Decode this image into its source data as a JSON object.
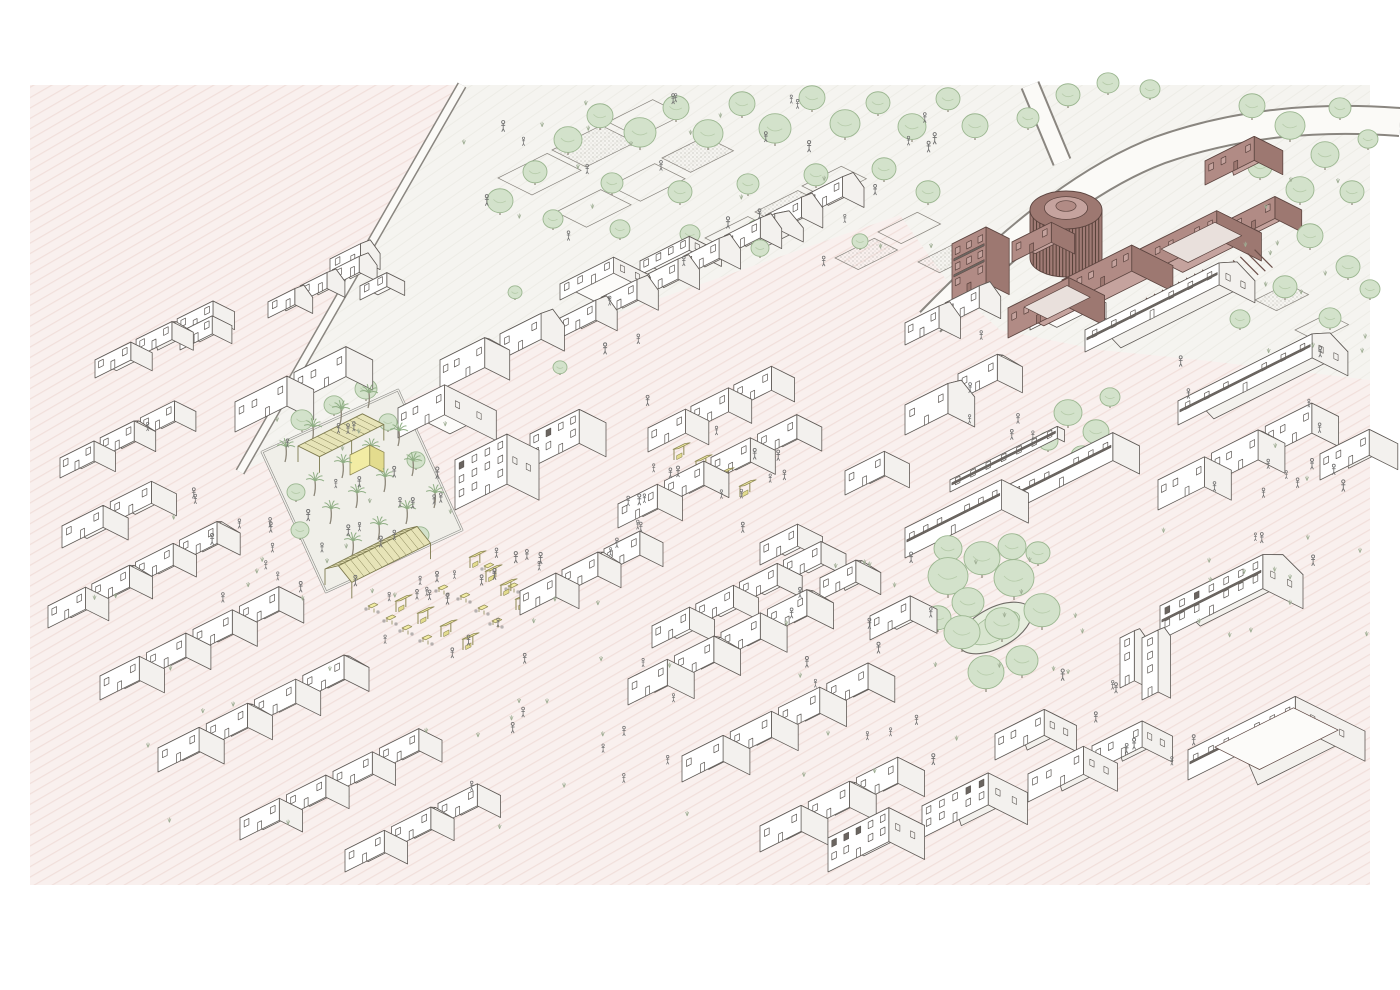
{
  "title": "Axonometric urban masterplan illustration",
  "palette": {
    "page": "#ffffff",
    "ground_pink": "#f9f0ee",
    "ground_hatch": "#f1dfdb",
    "park": "#f5f4f0",
    "park_hatch": "#edece6",
    "line": "#5f5a56",
    "house_front": "#ffffff",
    "house_side": "#f3f1ee",
    "house_top": "#fcfbf9",
    "roof_front": "#fdfcfa",
    "roof_back": "#f3f1ed",
    "mauve_front": "#b18b85",
    "mauve_side": "#9d7871",
    "mauve_top": "#c5a39e",
    "mauve_line": "#5d4540",
    "mauve_court": "#e9e0dc",
    "rotunda_body": "#a07b75",
    "rotunda_fin": "#564038",
    "yellow": "#f2eca4",
    "yellow_side": "#e3dc8e",
    "olive_line": "#8f8a55",
    "lattice": "#e7e4b8",
    "lattice_line": "#7d7a4e",
    "tree_fill": "#d3e2cb",
    "tree_line": "#9cb791",
    "trunk": "#8c8678",
    "people": "#6f6f6f",
    "shrub": "#9fae94",
    "road_edge": "#8a8680",
    "field_line": "#8a867f"
  },
  "scene": {
    "frame": {
      "x": 30,
      "y": 85,
      "w": 1340,
      "h": 800
    },
    "park": [
      [
        462,
        85
      ],
      [
        1370,
        85
      ],
      [
        1370,
        380
      ],
      [
        1200,
        360
      ],
      [
        1100,
        350
      ],
      [
        1000,
        330
      ],
      [
        950,
        285
      ],
      [
        900,
        215
      ],
      [
        560,
        333
      ],
      [
        240,
        472
      ]
    ],
    "roads": [
      {
        "d": "M 462 85 L 240 472",
        "w1": 10,
        "w2": 7
      },
      {
        "d": "M 930 322 C 1000 250 1080 180 1160 150 C 1240 122 1320 116 1400 122",
        "w1": 30,
        "w2": 26
      },
      {
        "d": "M 1030 85 L 1062 162",
        "w1": 20,
        "w2": 16
      }
    ],
    "fields": [
      [
        498,
        178,
        55,
        38,
        0
      ],
      [
        552,
        150,
        55,
        38,
        1
      ],
      [
        608,
        122,
        50,
        34,
        0
      ],
      [
        556,
        212,
        50,
        34,
        0
      ],
      [
        610,
        186,
        50,
        34,
        0
      ],
      [
        662,
        158,
        48,
        32,
        1
      ],
      [
        705,
        238,
        48,
        30,
        0
      ],
      [
        755,
        212,
        48,
        30,
        1
      ],
      [
        802,
        186,
        44,
        28,
        0
      ],
      [
        835,
        258,
        44,
        26,
        1
      ],
      [
        878,
        232,
        44,
        26,
        0
      ],
      [
        918,
        262,
        40,
        24,
        1
      ],
      [
        1255,
        300,
        36,
        24,
        1
      ],
      [
        1295,
        330,
        36,
        24,
        0
      ]
    ],
    "plaza": {
      "points": [
        [
          262,
          452
        ],
        [
          398,
          390
        ],
        [
          462,
          530
        ],
        [
          326,
          592
        ]
      ],
      "palms": [
        [
          285,
          462
        ],
        [
          312,
          442
        ],
        [
          340,
          424
        ],
        [
          368,
          408
        ],
        [
          398,
          446
        ],
        [
          370,
          462
        ],
        [
          342,
          478
        ],
        [
          314,
          496
        ],
        [
          330,
          524
        ],
        [
          356,
          508
        ],
        [
          384,
          492
        ],
        [
          412,
          476
        ],
        [
          352,
          556
        ],
        [
          378,
          540
        ],
        [
          406,
          524
        ],
        [
          434,
          508
        ]
      ],
      "pav_flat": {
        "x": 298,
        "y": 462,
        "w": 72,
        "d": 24,
        "z": 16
      },
      "pav_gable": {
        "x": 325,
        "y": 585,
        "w": 88,
        "d": 30,
        "h": 16,
        "rh": 10
      },
      "yellow_box": {
        "x": 350,
        "y": 475,
        "w": 22,
        "d": 16,
        "h": 20
      }
    },
    "house_rows": [
      [
        95,
        378,
        3,
        40,
        24,
        18,
        1,
        6
      ],
      [
        235,
        432,
        2,
        58,
        30,
        30,
        0,
        8
      ],
      [
        268,
        318,
        3,
        30,
        20,
        16,
        2,
        6
      ],
      [
        60,
        478,
        3,
        38,
        24,
        20,
        1,
        7
      ],
      [
        62,
        548,
        2,
        46,
        28,
        22,
        0,
        8
      ],
      [
        48,
        628,
        4,
        42,
        26,
        22,
        1,
        7
      ],
      [
        100,
        700,
        4,
        44,
        28,
        24,
        0,
        8
      ],
      [
        158,
        772,
        4,
        46,
        28,
        24,
        1,
        8
      ],
      [
        240,
        840,
        4,
        44,
        26,
        22,
        0,
        8
      ],
      [
        345,
        872,
        3,
        44,
        26,
        22,
        1,
        8
      ],
      [
        560,
        338,
        7,
        40,
        24,
        20,
        2,
        6
      ],
      [
        618,
        528,
        4,
        44,
        28,
        24,
        0,
        8
      ],
      [
        628,
        705,
        4,
        44,
        30,
        26,
        1,
        8
      ],
      [
        682,
        782,
        4,
        46,
        30,
        26,
        0,
        8
      ],
      [
        760,
        852,
        3,
        46,
        30,
        26,
        1,
        8
      ],
      [
        652,
        648,
        4,
        42,
        28,
        22,
        0,
        7
      ],
      [
        905,
        345,
        2,
        38,
        24,
        22,
        2,
        7
      ],
      [
        1158,
        510,
        3,
        52,
        30,
        30,
        1,
        8
      ],
      [
        520,
        615,
        3,
        40,
        26,
        24,
        1,
        7
      ],
      [
        648,
        452,
        3,
        42,
        26,
        24,
        0,
        6
      ]
    ],
    "house_singles": [
      [
        330,
        275,
        34,
        22,
        16,
        2,
        0
      ],
      [
        360,
        300,
        30,
        20,
        14,
        0,
        0
      ],
      [
        180,
        350,
        36,
        22,
        18,
        0,
        0
      ],
      [
        398,
        438,
        52,
        58,
        30,
        0,
        0
      ],
      [
        455,
        510,
        58,
        36,
        50,
        1,
        0
      ],
      [
        530,
        468,
        55,
        30,
        34,
        1,
        0
      ],
      [
        440,
        390,
        50,
        28,
        30,
        1,
        0
      ],
      [
        500,
        360,
        46,
        26,
        26,
        2,
        0
      ],
      [
        560,
        300,
        60,
        40,
        16,
        0,
        0
      ],
      [
        640,
        275,
        55,
        36,
        14,
        0,
        0
      ],
      [
        730,
        250,
        50,
        32,
        14,
        2,
        0
      ],
      [
        905,
        558,
        108,
        30,
        30,
        0,
        0
      ],
      [
        1010,
        512,
        115,
        30,
        28,
        0,
        0
      ],
      [
        905,
        435,
        48,
        30,
        30,
        2,
        0
      ],
      [
        958,
        400,
        44,
        28,
        26,
        1,
        0
      ],
      [
        950,
        492,
        120,
        8,
        12,
        0,
        0
      ],
      [
        1030,
        330,
        55,
        30,
        16,
        0,
        0
      ],
      [
        1085,
        352,
        150,
        40,
        22,
        2,
        0
      ],
      [
        1178,
        425,
        150,
        40,
        24,
        2,
        0
      ],
      [
        1320,
        480,
        55,
        32,
        26,
        1,
        0
      ],
      [
        828,
        872,
        68,
        40,
        34,
        0,
        0
      ],
      [
        922,
        838,
        74,
        44,
        32,
        1,
        0
      ],
      [
        1028,
        802,
        62,
        38,
        28,
        1,
        0
      ],
      [
        1092,
        772,
        56,
        34,
        26,
        1,
        0
      ],
      [
        1120,
        688,
        16,
        12,
        50,
        2,
        0
      ],
      [
        1142,
        700,
        18,
        14,
        62,
        2,
        0
      ],
      [
        1160,
        640,
        115,
        45,
        34,
        2,
        0
      ],
      [
        1188,
        780,
        120,
        78,
        30,
        1,
        0
      ],
      [
        995,
        760,
        55,
        36,
        26,
        1,
        0
      ],
      [
        870,
        640,
        45,
        30,
        24,
        0,
        0
      ],
      [
        820,
        600,
        40,
        28,
        22,
        1,
        0
      ],
      [
        760,
        565,
        42,
        28,
        22,
        0,
        0
      ],
      [
        845,
        495,
        44,
        28,
        24,
        0,
        0
      ],
      [
        952,
        300,
        38,
        26,
        56,
        0,
        1
      ],
      [
        1008,
        338,
        68,
        40,
        30,
        0,
        1
      ],
      [
        1012,
        262,
        44,
        26,
        20,
        0,
        1
      ],
      [
        1062,
        306,
        78,
        46,
        26,
        0,
        1
      ],
      [
        1138,
        278,
        88,
        50,
        28,
        0,
        1
      ],
      [
        1232,
        240,
        48,
        30,
        22,
        0,
        1
      ],
      [
        1205,
        185,
        55,
        32,
        24,
        1,
        1
      ]
    ],
    "rotunda": {
      "cx": 1066,
      "cy": 258,
      "rx": 36,
      "ry": 19,
      "h": 48
    },
    "pergolas": [
      [
        1146,
        322,
        8,
        9,
        26,
        24,
        14
      ],
      [
        1226,
        286,
        5,
        8,
        20,
        22,
        13
      ]
    ],
    "insets": [
      [
        1008,
        338,
        10,
        58,
        8,
        34,
        30,
        "mauve_court"
      ],
      [
        1138,
        278,
        14,
        74,
        12,
        42,
        28,
        "mauve_court"
      ],
      [
        1188,
        780,
        16,
        104,
        14,
        64,
        32,
        "house_top"
      ]
    ],
    "garden_oval": {
      "cx": 995,
      "cy": 628,
      "rx": 40,
      "ry": 20,
      "rot": -28
    },
    "trees": [
      [
        500,
        215,
        13
      ],
      [
        535,
        185,
        12
      ],
      [
        568,
        155,
        14
      ],
      [
        600,
        130,
        13
      ],
      [
        640,
        150,
        16
      ],
      [
        676,
        122,
        13
      ],
      [
        708,
        150,
        15
      ],
      [
        742,
        118,
        13
      ],
      [
        775,
        146,
        16
      ],
      [
        812,
        112,
        13
      ],
      [
        845,
        140,
        15
      ],
      [
        878,
        116,
        12
      ],
      [
        912,
        142,
        14
      ],
      [
        948,
        112,
        12
      ],
      [
        975,
        140,
        13
      ],
      [
        612,
        195,
        11
      ],
      [
        680,
        205,
        12
      ],
      [
        748,
        196,
        11
      ],
      [
        816,
        188,
        12
      ],
      [
        884,
        182,
        12
      ],
      [
        928,
        205,
        12
      ],
      [
        553,
        230,
        10
      ],
      [
        620,
        240,
        10
      ],
      [
        690,
        245,
        10
      ],
      [
        757,
        240,
        10
      ],
      [
        1252,
        120,
        13
      ],
      [
        1290,
        142,
        15
      ],
      [
        1325,
        170,
        14
      ],
      [
        1352,
        205,
        12
      ],
      [
        1300,
        205,
        14
      ],
      [
        1260,
        180,
        12
      ],
      [
        1340,
        120,
        11
      ],
      [
        1368,
        150,
        10
      ],
      [
        1310,
        250,
        13
      ],
      [
        1348,
        280,
        12
      ],
      [
        1285,
        300,
        12
      ],
      [
        1330,
        330,
        11
      ],
      [
        1370,
        300,
        10
      ],
      [
        1240,
        330,
        10
      ],
      [
        1068,
        108,
        12
      ],
      [
        1108,
        95,
        11
      ],
      [
        1150,
        100,
        10
      ],
      [
        1028,
        130,
        11
      ],
      [
        1068,
        428,
        14
      ],
      [
        1096,
        446,
        13
      ],
      [
        1082,
        468,
        11
      ],
      [
        1110,
        408,
        10
      ],
      [
        1048,
        452,
        10
      ],
      [
        948,
        598,
        20
      ],
      [
        982,
        578,
        18
      ],
      [
        1014,
        600,
        20
      ],
      [
        1042,
        630,
        18
      ],
      [
        1002,
        642,
        17
      ],
      [
        962,
        652,
        18
      ],
      [
        986,
        692,
        18
      ],
      [
        1022,
        678,
        16
      ],
      [
        948,
        564,
        14
      ],
      [
        1012,
        562,
        14
      ],
      [
        938,
        632,
        13
      ],
      [
        1038,
        566,
        12
      ],
      [
        968,
        620,
        16
      ],
      [
        302,
        432,
        11
      ],
      [
        334,
        416,
        10
      ],
      [
        366,
        401,
        11
      ],
      [
        296,
        502,
        9
      ],
      [
        388,
        432,
        9
      ],
      [
        416,
        470,
        9
      ],
      [
        300,
        540,
        9
      ],
      [
        420,
        545,
        9
      ],
      [
        760,
        258,
        9
      ],
      [
        700,
        262,
        8
      ],
      [
        860,
        250,
        8
      ],
      [
        560,
        375,
        7
      ],
      [
        515,
        300,
        7
      ]
    ],
    "stalls": [
      [
        396,
        612,
        1
      ],
      [
        418,
        624,
        1
      ],
      [
        441,
        637,
        1
      ],
      [
        463,
        650,
        1
      ],
      [
        470,
        568,
        2
      ],
      [
        486,
        582,
        2
      ],
      [
        501,
        596,
        2
      ],
      [
        516,
        610,
        2
      ],
      [
        652,
        448,
        1
      ],
      [
        674,
        460,
        1
      ],
      [
        696,
        472,
        1
      ],
      [
        718,
        485,
        1
      ],
      [
        740,
        497,
        1
      ]
    ],
    "tables": [
      [
        402,
        632
      ],
      [
        422,
        642
      ],
      [
        478,
        612
      ],
      [
        492,
        625
      ],
      [
        460,
        600
      ],
      [
        438,
        592
      ],
      [
        508,
        590
      ],
      [
        484,
        570
      ],
      [
        368,
        610
      ],
      [
        386,
        622
      ]
    ],
    "people_zones": [
      [
        265,
        420,
        200,
        190,
        26
      ],
      [
        375,
        555,
        170,
        110,
        16
      ],
      [
        635,
        430,
        150,
        105,
        12
      ],
      [
        460,
        95,
        480,
        170,
        22
      ],
      [
        1150,
        350,
        210,
        150,
        10
      ],
      [
        545,
        300,
        110,
        260,
        10
      ],
      [
        770,
        555,
        170,
        210,
        12
      ],
      [
        70,
        400,
        230,
        210,
        8
      ],
      [
        450,
        650,
        240,
        160,
        10
      ],
      [
        1060,
        620,
        150,
        150,
        8
      ],
      [
        960,
        330,
        80,
        120,
        6
      ],
      [
        1240,
        430,
        120,
        180,
        6
      ]
    ],
    "shrub_zones": [
      [
        60,
        500,
        300,
        330,
        14
      ],
      [
        420,
        600,
        300,
        230,
        14
      ],
      [
        1150,
        340,
        220,
        300,
        16
      ],
      [
        460,
        95,
        480,
        170,
        14
      ],
      [
        760,
        560,
        220,
        240,
        12
      ],
      [
        1240,
        100,
        130,
        260,
        12
      ],
      [
        270,
        410,
        200,
        200,
        10
      ],
      [
        950,
        560,
        140,
        160,
        8
      ]
    ]
  }
}
